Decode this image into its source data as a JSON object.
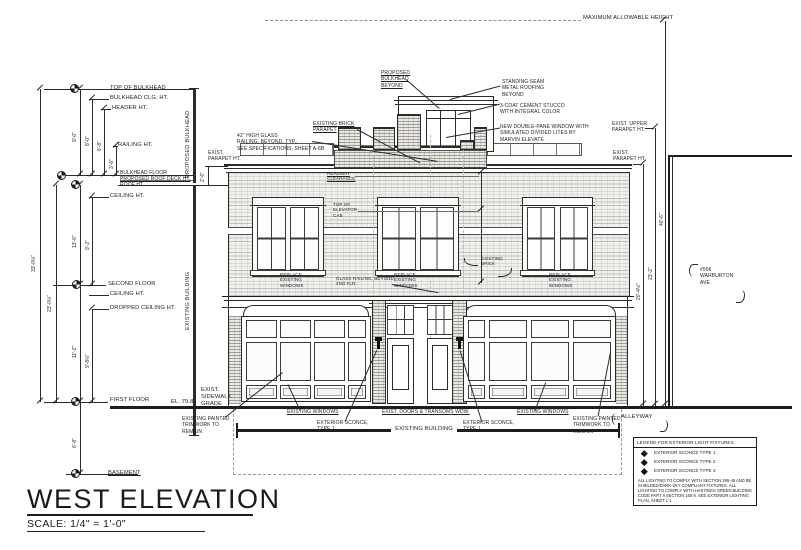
{
  "sheet": {
    "title": "WEST ELEVATION",
    "scale": "SCALE: 1/4\" = 1'-0\""
  },
  "top": {
    "max_height": "MAXIMUM ALLOWABLE HEIGHT"
  },
  "levels": {
    "top_of_bulkhead": "TOP OF BULKHEAD",
    "bulkhead_clg": "BULKHEAD CLG. HT.",
    "header": "HEADER HT.",
    "railing": "RAILING HT.",
    "bulkhead_floor": "BULKHEAD FLOOR",
    "roof_deck": "PROPOSED ROOF DECK HT.",
    "roof": "ROOF HT.",
    "ceiling_2": "CEILING HT.",
    "second_floor": "SECOND FLOOR",
    "ceiling_1": "CEILING HT.",
    "dropped_ceiling": "DROPPED CEILING HT.",
    "first_floor": "FIRST FLOOR",
    "basement": "BASEMENT"
  },
  "dims": {
    "total": "33'-0½\"",
    "first_to_roof": "23'-0½\"",
    "roof_to_second": "13'-6\"",
    "ceiling_2nd": "9'-2\"",
    "second_to_first": "11'-2\"",
    "dropped": "9'-8½\"",
    "bulkhead_total": "9'-0\"",
    "bulkhead_clg": "8'-0\"",
    "header": "6'-8\"",
    "railing": "3'-6\"",
    "basement": "6'-8\"",
    "parapet": "2'-6\"",
    "right_parapet": "20'-4½\"",
    "right_upper": "23'-2\"",
    "max_height": "40'-6\""
  },
  "vertical_refs": {
    "proposed_bulkhead": "PROPOSED BULKHEAD",
    "existing_building": "EXISTING BUILDING"
  },
  "notes": {
    "proposed_bulkhead_beyond": "PROPOSED\nBULKHEAD\nBEYOND",
    "standing_seam": "STANDING SEAM\nMETAL ROOFING\nBEYOND",
    "stucco": "3-COAT CEMENT STUCCO\nWITH INTEGRAL COLOR",
    "new_window": "NEW DOUBLE-PANE WINDOW WITH\nSIMULATED DIVIDED LITES BY\nMARVIN ELEVATE",
    "existing_brick_parapet": "EXISTING BRICK\nPARAPET",
    "glass_railing": "42\" HIGH GLASS\nRAILING, BEYOND, TYP.,\nSEE SPECIFICATIONS, SHEET A-6B",
    "exist_parapet_ht": "EXIST.\nPARAPET HT.",
    "exist_upper_parapet_ht": "EXIST. UPPER\nPARAPET HT.",
    "headway": "HEADWAY\nCLEARANCE",
    "elevator_cab": "TOP OF\nELEVATOR\nCAB",
    "existing_brick": "EXISTING\nBRICK",
    "replace_windows": "REPLACE\nEXISTING\nWINDOWS",
    "railing_beyond": "GLASS RAILING, BEYOND\n2ND FLR.",
    "sidewalk_el": "EL. 79.8",
    "sidewalk": "EXIST.\nSIDEWALK\nGRADE",
    "painted_trim": "EXISTING PAINTED\nTRIMWORK TO\nREMAIN",
    "existing_windows": "EXISTING WINDOWS",
    "doors_transoms": "EXIST. DOORS & TRANSOMS WDW.",
    "sconce_type1": "EXTERIOR SCONCE,\nTYPE 1",
    "existing_building_dim": "EXISTING BUILDING",
    "alleyway": "ALLEYWAY",
    "neighbor": "#506\nWARBURTON\nAVE."
  },
  "legend": {
    "title": "LEGEND FOR EXTERIOR LIGHT FIXTURES",
    "items": [
      "EXTERIOR SCONCE TYPE 1",
      "EXTERIOR SCONCE TYPE 2",
      "EXTERIOR SCONCE TYPE 3"
    ],
    "note": "ALL LIGHTING TO COMPLY WITH SECTION 295-49 AND BE SHIELDED/DARK-SKY COMPLIANT FIXTURES. ALL LIGHTING TO COMPLY WITH HASTINGS GREEN BUILDING CODE PART II SECTION 160-8. SEE EXTERIOR LIGHTING PLAN, SHEET L-1"
  },
  "colors": {
    "line": "#2b2b2b",
    "paper": "#ffffff",
    "brick": "#f1f0ed"
  }
}
